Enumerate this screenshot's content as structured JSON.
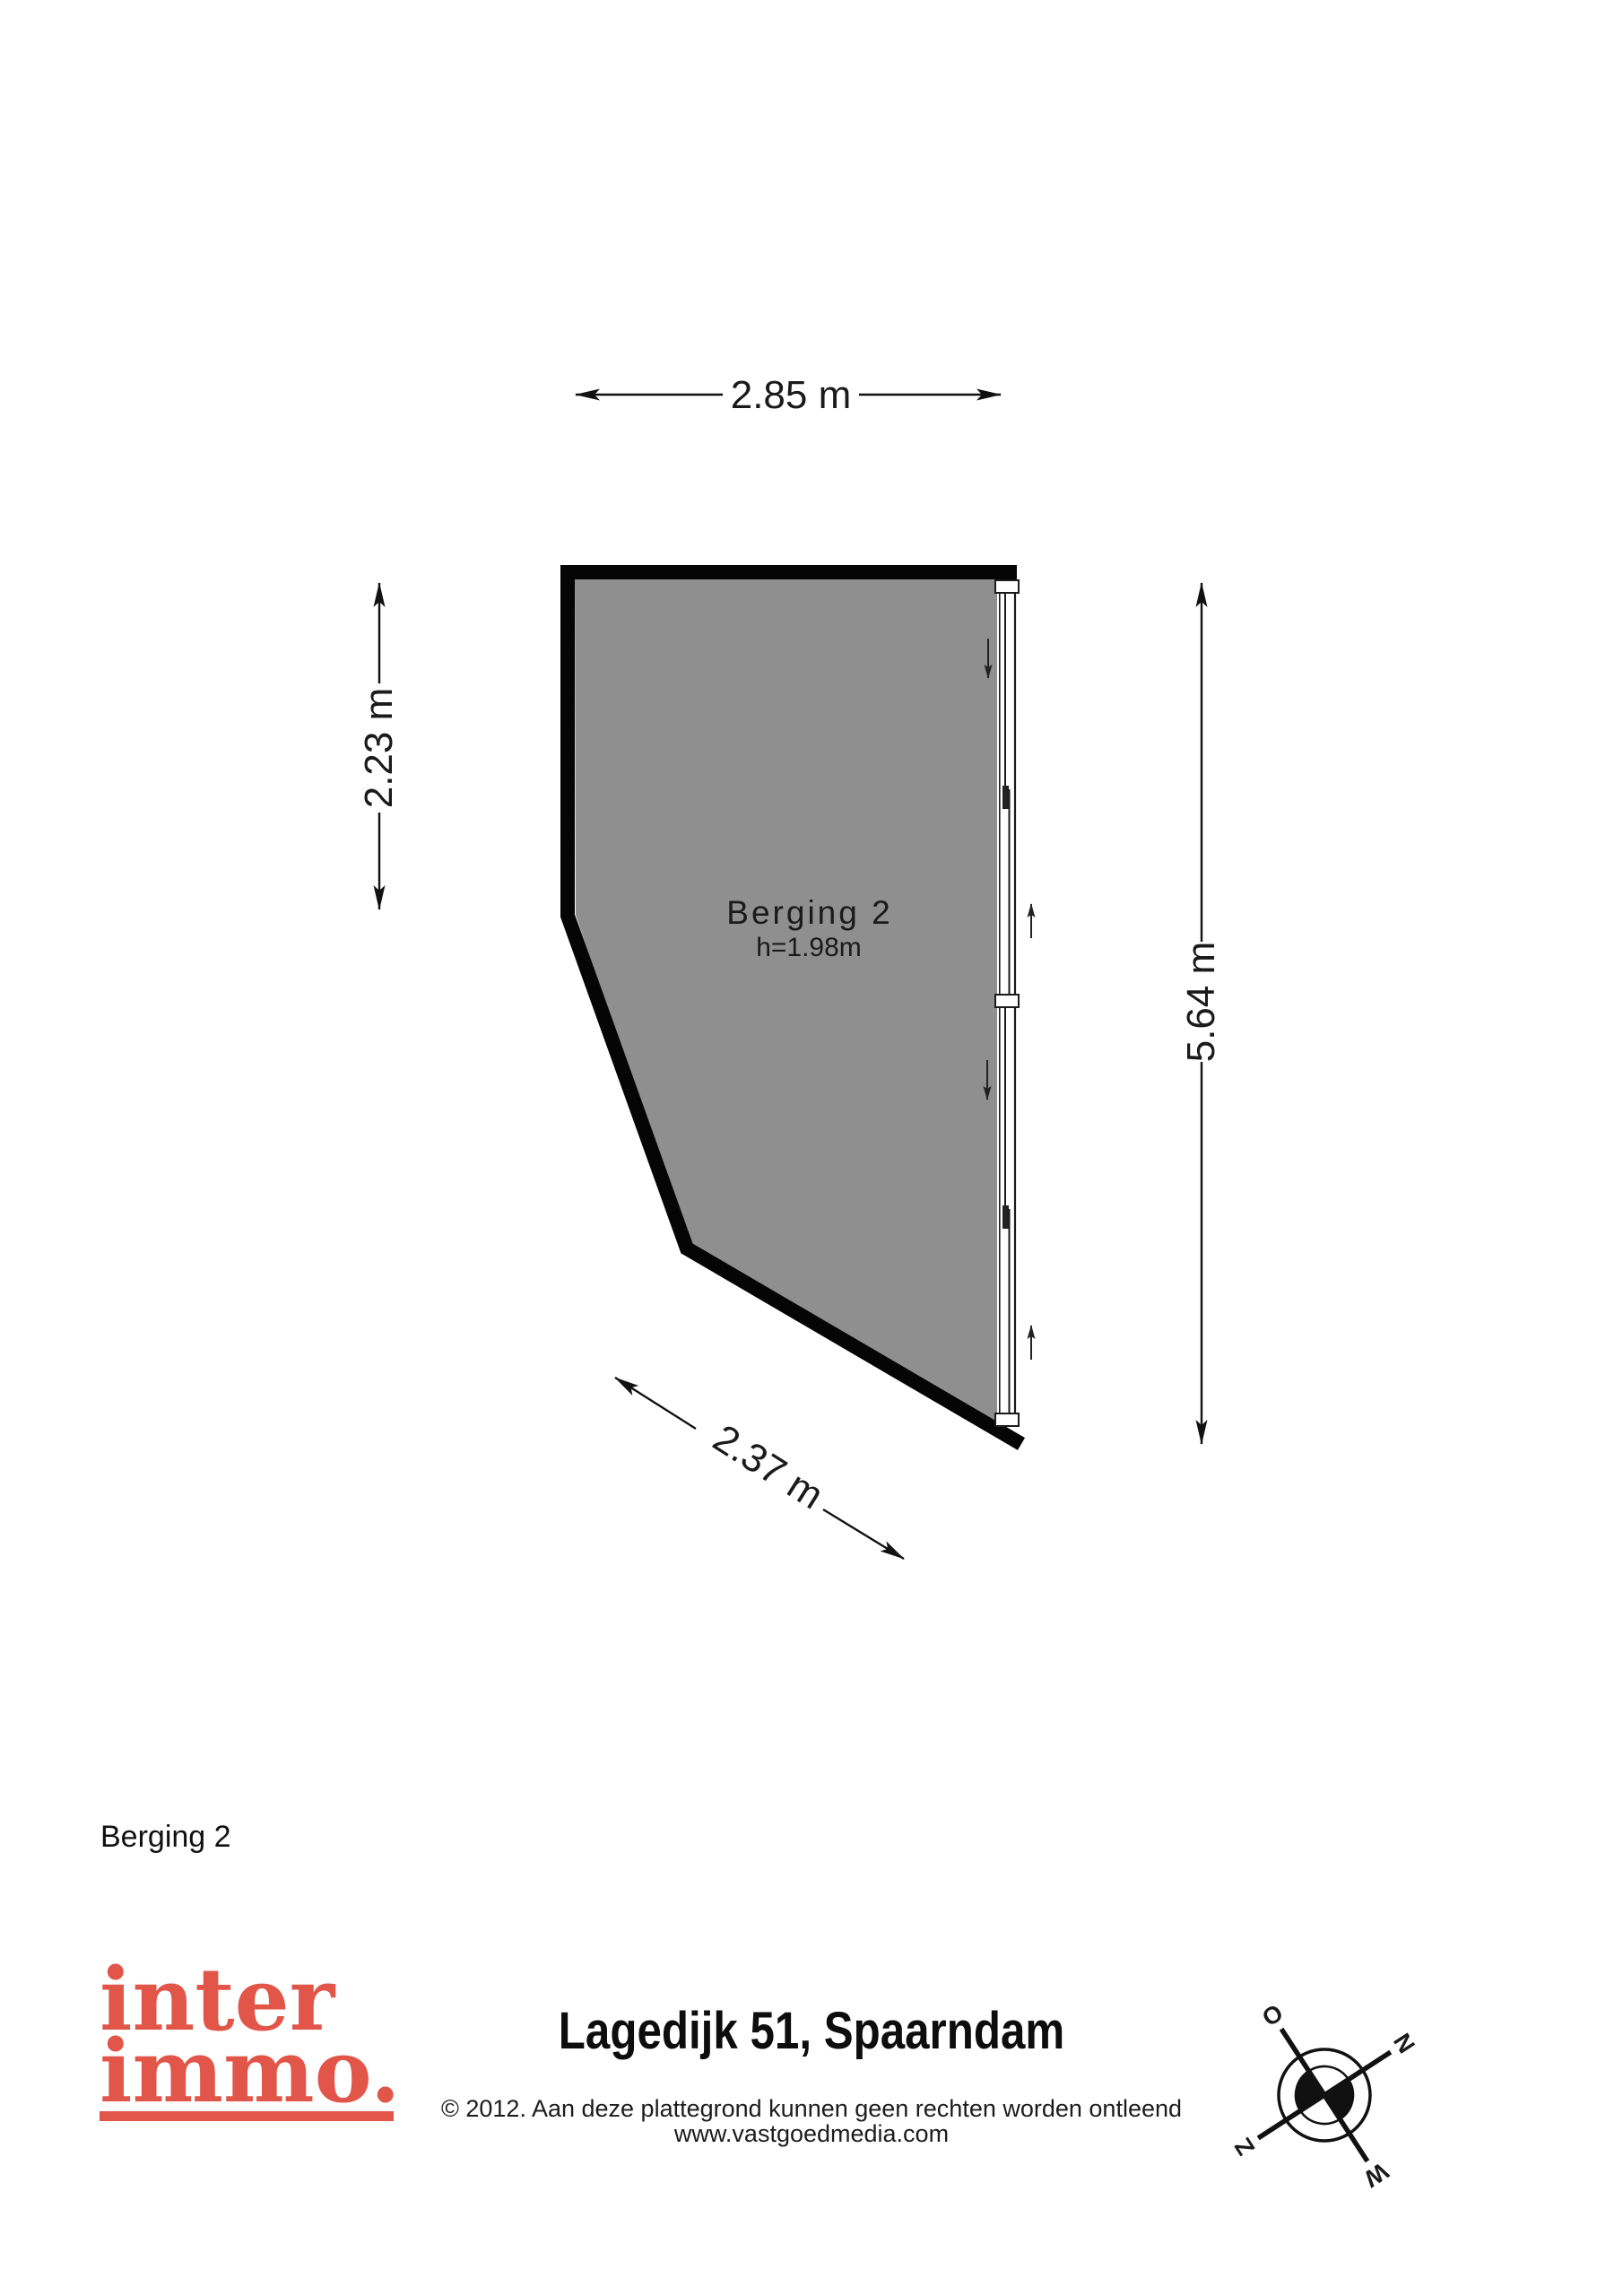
{
  "page": {
    "background": "#ffffff"
  },
  "plan": {
    "room_label": "Berging 2",
    "room_height_label": "h=1.98m",
    "floor_fill": "#8f8f8f",
    "wall_color": "#050505",
    "dim_top": "2.85 m",
    "dim_left": "2.23 m",
    "dim_right": "5.64 m",
    "dim_bottom": "2.37 m"
  },
  "floor_label": "Berging 2",
  "footer": {
    "logo_line1": "inter",
    "logo_line2": "immo.",
    "logo_color": "#e15649",
    "address_title": "Lagedijk 51, Spaarndam",
    "copyright": "© 2012. Aan deze plattegrond kunnen geen rechten worden ontleend",
    "website": "www.vastgoedmedia.com"
  },
  "compass": {
    "n": "N",
    "o": "O",
    "z": "Z",
    "w": "W"
  }
}
